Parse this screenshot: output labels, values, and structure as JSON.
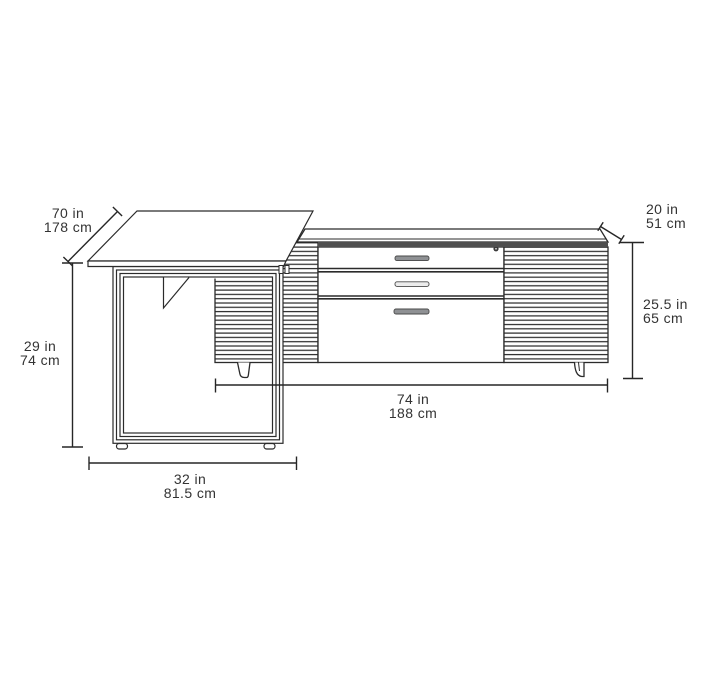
{
  "diagram": {
    "kind": "furniture-dimension-line-drawing",
    "units_shown": [
      "in",
      "cm"
    ]
  },
  "dimensions": {
    "desk_depth": {
      "in": "70 in",
      "cm": "178 cm"
    },
    "credenza_depth": {
      "in": "20 in",
      "cm": "51 cm"
    },
    "desk_height": {
      "in": "29 in",
      "cm": "74 cm"
    },
    "credenza_height": {
      "in": "25.5 in",
      "cm": "65 cm"
    },
    "credenza_width": {
      "in": "74 in",
      "cm": "188 cm"
    },
    "desk_width": {
      "in": "32 in",
      "cm": "81.5 cm"
    }
  },
  "colors": {
    "background": "#ffffff",
    "line": "#2b2b2b",
    "dimension_line": "#262626",
    "text": "#333333",
    "credenza_top_band": "#4f4f4f",
    "drawer_handle": "#8f9194",
    "drawer_handle_middle": "#ececec"
  }
}
